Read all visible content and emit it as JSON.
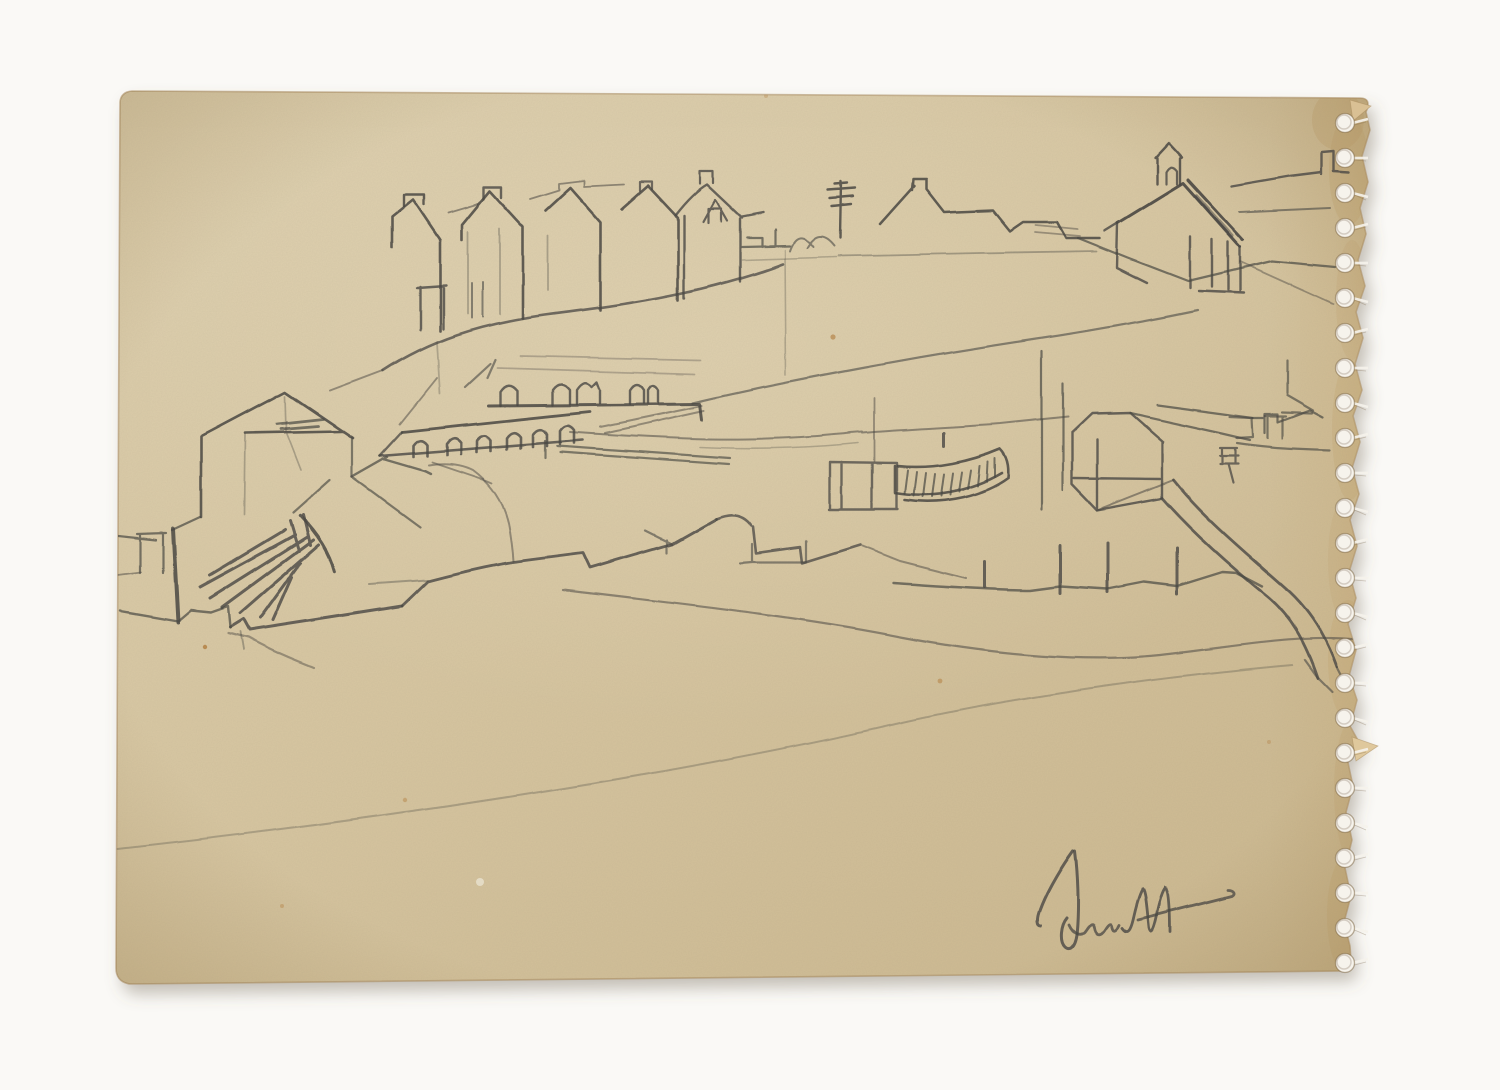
{
  "artwork": {
    "type": "pencil-sketch-scan",
    "description": "Pencil sketch of a coastal hillside village with terraced houses, a church, an arched arcade, harbour walls and a beached boat, drawn on an aged cream sketchbook page with a torn spiral-binding perforated edge on the right and an illegible pencil signature at bottom right.",
    "signature_legible": false,
    "colors": {
      "background": "#faf9f6",
      "paper": "#d7c6a1",
      "paper_light": "#ded0af",
      "paper_dark": "#cbb78e",
      "paper_edge": "#c2a470",
      "edge_line": "#a8895c",
      "pencil": "#4a4843",
      "hole": "#f6f3ec",
      "stain": "#b5854a",
      "shadow": "rgba(105,95,75,0.38)"
    },
    "paper_outline": "M132,91 Q121,92 120,102 L116,968 Q116,982 130,984 L1344,971 Q1352,970 1351,961 L1350,946 L1344,922 L1351,896 L1345,868 L1352,840 L1346,812 L1353,786 L1347,758 L1360,744 L1350,726 L1357,700 L1349,676 L1356,650 L1348,624 L1356,598 L1349,572 L1357,546 L1350,520 L1359,494 L1352,468 L1360,442 L1353,416 L1362,390 L1355,364 L1363,338 L1356,312 L1365,286 L1358,260 L1366,234 L1360,208 L1368,182 L1362,156 L1370,130 L1366,112 Q1372,98 1360,98 Z",
    "perforation": {
      "cx": 1345,
      "start_y": 123,
      "spacing": 35,
      "count": 25,
      "r": 9.5
    },
    "edge_blotches": [
      {
        "cx": 1349,
        "cy": 170,
        "rx": 20,
        "ry": 55,
        "o": 0.3
      },
      {
        "cx": 1352,
        "cy": 300,
        "rx": 16,
        "ry": 60,
        "o": 0.22
      },
      {
        "cx": 1350,
        "cy": 430,
        "rx": 18,
        "ry": 70,
        "o": 0.28
      },
      {
        "cx": 1344,
        "cy": 560,
        "rx": 16,
        "ry": 60,
        "o": 0.22
      },
      {
        "cx": 1348,
        "cy": 660,
        "rx": 20,
        "ry": 60,
        "o": 0.3
      },
      {
        "cx": 1352,
        "cy": 790,
        "rx": 18,
        "ry": 70,
        "o": 0.26
      },
      {
        "cx": 1347,
        "cy": 915,
        "rx": 20,
        "ry": 60,
        "o": 0.3
      },
      {
        "cx": 1338,
        "cy": 120,
        "rx": 26,
        "ry": 30,
        "o": 0.33
      }
    ],
    "flaps": [
      {
        "points": "1352,737 1378,746 1356,761",
        "fill": "#dfc89c"
      },
      {
        "points": "1350,100 1371,106 1353,121",
        "fill": "#d9c094"
      }
    ],
    "stains": [
      {
        "x": 833,
        "y": 337,
        "r": 2.6,
        "o": 0.7
      },
      {
        "x": 1353,
        "y": 521,
        "r": 2.8,
        "o": 0.6
      },
      {
        "x": 405,
        "y": 800,
        "r": 2.2,
        "o": 0.5
      },
      {
        "x": 940,
        "y": 681,
        "r": 2.4,
        "o": 0.6
      },
      {
        "x": 282,
        "y": 906,
        "r": 2.0,
        "o": 0.45
      },
      {
        "x": 1269,
        "y": 742,
        "r": 2.0,
        "o": 0.4
      },
      {
        "x": 766,
        "y": 96,
        "r": 2.0,
        "o": 0.35
      },
      {
        "x": 205,
        "y": 647,
        "r": 2.2,
        "o": 0.9
      }
    ],
    "stroke_groups": [
      {
        "name": "hill-terrace-houses",
        "strokes": [
          {
            "d": "M383,371 C430,340 480,324 545,315 C615,306 700,295 783,264",
            "w": 2.6,
            "o": 0.75
          },
          {
            "d": "M420,330 L420,287 M443,329 L443,286 M417,288 L446,286",
            "w": 2.4,
            "o": 0.8
          },
          {
            "d": "M472,318 L472,283 M483,317 L483,282",
            "w": 2,
            "o": 0.6
          },
          {
            "d": "M392,248 L392,217 L413,200 L440,240 L440,331",
            "w": 2.6,
            "o": 0.85
          },
          {
            "d": "M404,206 L404,195 L424,195 L424,205",
            "w": 2.4,
            "o": 0.85
          },
          {
            "d": "M462,240 L462,225 L490,191 L523,227 L523,318",
            "w": 2.6,
            "o": 0.85
          },
          {
            "d": "M484,199 L484,187 L502,187 L502,198",
            "w": 2.4,
            "o": 0.8
          },
          {
            "d": "M448,213 L478,204 M530,199 L559,190 L559,184 L584,181 L584,187 L624,185",
            "w": 1.8,
            "o": 0.55
          },
          {
            "d": "M545,211 L570,188 L600,222 L600,310",
            "w": 2.6,
            "o": 0.85
          },
          {
            "d": "M622,209 L648,186 L678,218 L678,300",
            "w": 2.6,
            "o": 0.85
          },
          {
            "d": "M640,191 L640,182 L652,182 L652,189",
            "w": 2.2,
            "o": 0.75
          },
          {
            "d": "M676,215 C690,197 700,189 707,185 L742,218 M684,216 L684,298 M740,219 L740,281 M742,217 L763,213",
            "w": 2.4,
            "o": 0.8
          },
          {
            "d": "M703,222 L715,200 L727,221 M708,223 L708,209 L721,209 L721,222",
            "w": 2.2,
            "o": 0.8
          },
          {
            "d": "M700,184 L700,171 L713,171 L713,183",
            "w": 2.2,
            "o": 0.8
          },
          {
            "d": "M468,232 L468,314 M500,229 L500,314 M548,236 L548,290",
            "w": 1.8,
            "o": 0.35
          },
          {
            "d": "M437,342 L440,394",
            "w": 1.8,
            "o": 0.3
          },
          {
            "d": "M383,371 L330,391",
            "w": 2,
            "o": 0.5
          }
        ]
      },
      {
        "name": "village-skyline",
        "strokes": [
          {
            "d": "M742,247 L790,246 M762,238 L762,247 M775,230 L775,246 M747,238 L762,238",
            "w": 2.2,
            "o": 0.7
          },
          {
            "d": "M790,251 Q798,228 813,247 M807,248 Q819,227 834,246",
            "w": 2,
            "o": 0.6
          },
          {
            "d": "M840,238 L841,181 M828,190 L855,188 M830,198 L853,196 M832,206 L851,204 M835,184 L847,183",
            "w": 2.4,
            "o": 0.85
          },
          {
            "d": "M880,224 L914,186 M912,190 L913,179 L926,179 L926,189 L944,212 L993,210 L1010,231 L1023,222 L1057,222 L1066,238 L1100,238",
            "w": 2.5,
            "o": 0.85
          },
          {
            "d": "M838,256 L980,253 L1097,251",
            "w": 1.8,
            "o": 0.4
          },
          {
            "d": "M742,260 L836,257",
            "w": 1.6,
            "o": 0.3
          },
          {
            "d": "M785,250 L786,375",
            "w": 1.6,
            "o": 0.3
          }
        ]
      },
      {
        "name": "church",
        "strokes": [
          {
            "d": "M1157,184 L1157,158 L1155,158 L1169,143 L1182,157 L1180,158 L1180,184",
            "w": 2.4,
            "o": 0.85
          },
          {
            "d": "M1166,184 L1166,172 Q1171,163 1177,171 L1177,184",
            "w": 2.2,
            "o": 0.8
          },
          {
            "d": "M1118,223 L1183,183 L1240,247 M1188,180 L1243,240",
            "w": 3,
            "o": 0.9
          },
          {
            "d": "M1196,196 L1232,236",
            "w": 4,
            "o": 0.5
          },
          {
            "d": "M1118,223 L1105,231 M1118,223 L1117,268 L1147,283",
            "w": 2.4,
            "o": 0.8
          },
          {
            "d": "M1240,247 L1240,292 M1212,287 L1212,240 M1228,290 L1228,242 M1199,291 L1244,293 M1190,237 L1190,288",
            "w": 2.4,
            "o": 0.8
          },
          {
            "d": "M1232,186 L1290,176 L1322,172 M1322,174 L1322,152 L1334,151 L1334,171 L1349,172",
            "w": 2.4,
            "o": 0.8
          },
          {
            "d": "M1240,212 L1330,208",
            "w": 2,
            "o": 0.6
          },
          {
            "d": "M1078,238 L1128,258 L1188,281 L1272,261 L1335,267",
            "w": 2.2,
            "o": 0.7
          },
          {
            "d": "M1240,262 L1333,304",
            "w": 1.8,
            "o": 0.45
          },
          {
            "d": "M1035,225 L1078,229 M1035,232 L1080,236",
            "w": 1.8,
            "o": 0.45
          }
        ]
      },
      {
        "name": "hillside-line",
        "strokes": [
          {
            "d": "M693,403 C800,378 930,355 1030,340 C1090,331 1150,320 1198,310",
            "w": 2.2,
            "o": 0.6
          }
        ]
      },
      {
        "name": "arcade-building",
        "strokes": [
          {
            "d": "M488,406 L700,404 L702,420",
            "w": 3,
            "o": 0.85
          },
          {
            "d": "M500,406 L500,392 Q508,380 517,391 L517,405",
            "w": 2.4,
            "o": 0.8
          },
          {
            "d": "M553,405 L553,390 Q561,379 570,390 L570,404",
            "w": 2.4,
            "o": 0.8
          },
          {
            "d": "M577,404 L577,390 Q585,378 592,387 L597,382 L600,390 L600,403",
            "w": 2.4,
            "o": 0.8
          },
          {
            "d": "M630,404 L630,390 Q637,379 644,390 L644,403 M648,403 L648,390 Q653,381 658,390 L658,403",
            "w": 2.4,
            "o": 0.8
          },
          {
            "d": "M497,368 L695,374 M520,356 L700,360",
            "w": 1.7,
            "o": 0.32
          },
          {
            "d": "M490,364 L465,387 M495,360 L487,378",
            "w": 2.2,
            "o": 0.6
          },
          {
            "d": "M402,432 L590,412",
            "w": 2.8,
            "o": 0.85
          },
          {
            "d": "M380,456 L583,440",
            "w": 2.6,
            "o": 0.8
          },
          {
            "d": "M380,456 L402,432",
            "w": 2.4,
            "o": 0.75
          },
          {
            "d": "M413,457 L413,446 Q420,436 427,445 L427,456 M447,455 L447,444 Q454,434 461,443 L461,454 M477,452 L477,441 Q484,431 491,440 L491,451 M507,449 L507,438 Q514,428 521,437 L521,448 M533,447 L533,435 Q540,425 547,434 L547,446 M560,444 L560,431 Q567,421 574,430 L574,443",
            "w": 2.6,
            "o": 0.8
          },
          {
            "d": "M600,427 L702,406 M605,433 L704,411",
            "w": 2,
            "o": 0.5
          },
          {
            "d": "M387,457 L352,477 M383,459 L424,471 L430,474",
            "w": 2.4,
            "o": 0.7
          },
          {
            "d": "M432,462 L485,480 L492,483",
            "w": 1.8,
            "o": 0.5
          },
          {
            "d": "M437,378 L400,424",
            "w": 1.8,
            "o": 0.5
          },
          {
            "d": "M557,446 L730,458 M560,452 L729,464 M545,441 L545,458",
            "w": 2.2,
            "o": 0.65
          }
        ]
      },
      {
        "name": "left-building-rocks",
        "strokes": [
          {
            "d": "M202,436 L285,392 L353,438 M245,433 L341,431 M201,437 L201,517",
            "w": 2.6,
            "o": 0.85
          },
          {
            "d": "M277,424 L323,419 M281,429 L318,426",
            "w": 2.8,
            "o": 0.7
          },
          {
            "d": "M245,434 L244,514 M285,396 L286,431 M287,434 L301,470",
            "w": 1.7,
            "o": 0.35
          },
          {
            "d": "M352,438 L352,477 L420,527 M330,480 L293,513",
            "w": 2.2,
            "o": 0.65
          },
          {
            "d": "M200,517 L172,530 M118,536 L156,540 M140,535 L140,573 M163,533 L163,573 M137,534 L166,533",
            "w": 2.2,
            "o": 0.7
          },
          {
            "d": "M173,529 L178,622",
            "w": 4,
            "o": 0.85
          },
          {
            "d": "M118,575 L141,572",
            "w": 1.8,
            "o": 0.5
          },
          {
            "d": "M120,611 L178,621 M178,621 L191,610 L211,612 L228,606 L230,627",
            "w": 2.4,
            "o": 0.7
          },
          {
            "d": "M300,516 Q327,544 334,571",
            "w": 3.4,
            "o": 0.85
          },
          {
            "d": "M285,530 L210,575 M295,535 L200,587 M307,537 L210,598 M313,540 L222,607 M318,545 L240,613 M300,563 L260,618 M292,577 L273,620 M303,515 L310,545 M290,521 L299,551",
            "w": 3,
            "o": 0.8
          },
          {
            "d": "M230,627 L243,619 L249,630 L402,606",
            "w": 3,
            "o": 0.8
          },
          {
            "d": "M228,633 L248,638 Q275,653 314,668",
            "w": 2.2,
            "o": 0.45
          },
          {
            "d": "M240,632 L243,650",
            "w": 1.8,
            "o": 0.4
          }
        ]
      },
      {
        "name": "harbour",
        "strokes": [
          {
            "d": "M402,606 L428,581 C470,570 490,566 513,562 L583,553 L590,568 L672,544 L716,519",
            "w": 2.8,
            "o": 0.8
          },
          {
            "d": "M370,584 L428,580",
            "w": 2,
            "o": 0.4
          },
          {
            "d": "M716,519 Q740,509 752,526 M754,527 L757,553 L800,547 L802,563 L860,545",
            "w": 2.6,
            "o": 0.75
          },
          {
            "d": "M646,531 L672,544 M667,540 L667,553 M753,544 L753,562 L806,562 L806,541 M741,563 L753,562",
            "w": 2.2,
            "o": 0.6
          },
          {
            "d": "M428,465 Q455,461 473,470 Q500,490 508,523 Q512,545 513,561",
            "w": 2,
            "o": 0.5
          },
          {
            "d": "M830,462 L897,463 M830,462 L830,509 M842,462 L842,509 M872,463 L872,508 M897,463 L897,508 M829,509 L898,509",
            "w": 2.4,
            "o": 0.75
          },
          {
            "d": "M874,461 L874,398",
            "w": 1.8,
            "o": 0.5
          },
          {
            "d": "M895,466 L895,493 C930,499 970,492 1002,473 M898,466 C935,470 972,461 1000,449 M905,500 C945,506 985,495 1008,478 M1000,449 Q1010,459 1008,478",
            "w": 2.6,
            "o": 0.85
          },
          {
            "d": "M908,470 L905,494 M917,472 L914,496 M926,473 L923,497 M935,474 L932,497 M944,474 L941,496 M953,473 L950,495 M962,472 L959,492 M971,470 L968,489 M980,466 L978,486 M988,462 L987,482 M995,458 L995,477",
            "w": 2,
            "o": 0.7
          },
          {
            "d": "M943,446 L943,433",
            "w": 3,
            "o": 0.8
          },
          {
            "d": "M570,432 C640,437 700,440 748,439 C800,438 830,435 862,432 M862,433 C910,429 960,427 1000,424 L1068,417",
            "w": 2,
            "o": 0.55
          },
          {
            "d": "M700,447 C760,450 820,447 858,443",
            "w": 1.6,
            "o": 0.3
          }
        ]
      },
      {
        "name": "right-sheds-wall",
        "strokes": [
          {
            "d": "M1042,510 L1042,351 M1063,490 L1063,383",
            "w": 2.2,
            "o": 0.7
          },
          {
            "d": "M1072,433 L1092,414 L1130,413 L1163,442 M1072,433 L1072,484 M1162,442 L1162,498 M1074,478 L1160,479 M1097,440 L1097,510 M1072,484 L1097,510 L1162,498",
            "w": 2.4,
            "o": 0.8
          },
          {
            "d": "M1130,413 L1220,433 L1250,440 M1157,405 L1253,418",
            "w": 2.2,
            "o": 0.7
          },
          {
            "d": "M1220,448 L1237,448 M1220,456 L1238,456 M1222,448 L1222,464 M1235,448 L1235,464 M1220,464 L1238,464 M1228,464 L1233,483",
            "w": 2.2,
            "o": 0.75
          },
          {
            "d": "M1253,418 L1265,418 M1265,433 L1265,414 L1278,414 L1278,422 L1310,410 L1323,417",
            "w": 2.2,
            "o": 0.7
          },
          {
            "d": "M1282,412 L1312,413 M1268,438 L1268,417 M1283,438 L1283,417 M1265,416 L1286,416 M1237,443 C1270,448 1300,449 1330,450 M1230,417 L1252,418 L1253,437 L1237,438 M1287,360 L1287,393 M1287,395 L1313,410",
            "w": 2.2,
            "o": 0.65
          },
          {
            "d": "M1173,480 C1205,520 1250,556 1290,592 C1310,611 1326,636 1337,667 M1162,498 C1190,530 1230,566 1267,596 C1291,616 1306,642 1318,678",
            "w": 2.8,
            "o": 0.8
          },
          {
            "d": "M1097,510 L1173,480",
            "w": 2,
            "o": 0.55
          },
          {
            "d": "M1305,660 L1318,678 M1318,678 L1332,692 M1337,667 L1349,690",
            "w": 2.2,
            "o": 0.6
          },
          {
            "d": "M985,561 L985,587 M1060,546 L1060,593 M1107,543 L1107,592 M1177,548 L1177,594",
            "w": 3,
            "o": 0.8
          },
          {
            "d": "M893,583 C950,587 1000,590 1030,590 L1060,586 L1107,589 L1143,582 L1177,586 L1222,572 L1237,573 L1262,586",
            "w": 2.4,
            "o": 0.7
          },
          {
            "d": "M862,546 L900,561 L967,578",
            "w": 2,
            "o": 0.5
          }
        ]
      },
      {
        "name": "foreground-lines",
        "strokes": [
          {
            "d": "M563,590 C680,604 800,617 900,637 C1000,656 1090,662 1160,655 C1240,646 1300,634 1357,640",
            "w": 2.2,
            "o": 0.55
          },
          {
            "d": "M118,849 C400,818 700,770 900,723 C1030,694 1180,675 1292,665",
            "w": 2,
            "o": 0.3
          }
        ]
      },
      {
        "name": "signature",
        "strokes": [
          {
            "d": "M1073,851 C1065,862 1048,888 1040,910 C1036,920 1037,926 1041,926",
            "w": 3,
            "o": 0.8
          },
          {
            "d": "M1075,851 C1078,875 1079,905 1077,930 C1076,945 1071,952 1065,947 C1059,941 1061,925 1067,918",
            "w": 3,
            "o": 0.8
          },
          {
            "d": "M1069,925 C1073,934 1081,938 1086,930 C1090,924 1093,921 1094,927 C1095,934 1100,937 1105,929 C1108,924 1111,921 1112,927 C1113,932 1116,931 1119,925",
            "w": 2.8,
            "o": 0.75
          },
          {
            "d": "M1122,928 C1128,936 1131,930 1134,916 C1137,903 1140,893 1143,889 C1146,893 1147,910 1149,928 C1151,936 1154,930 1157,915 C1160,901 1163,891 1166,888 C1169,892 1170,912 1170,932",
            "w": 2.8,
            "o": 0.8
          },
          {
            "d": "M1138,920 C1170,912 1200,904 1232,896 C1236,894 1234,890 1228,890",
            "w": 2.8,
            "o": 0.75
          }
        ]
      }
    ]
  }
}
